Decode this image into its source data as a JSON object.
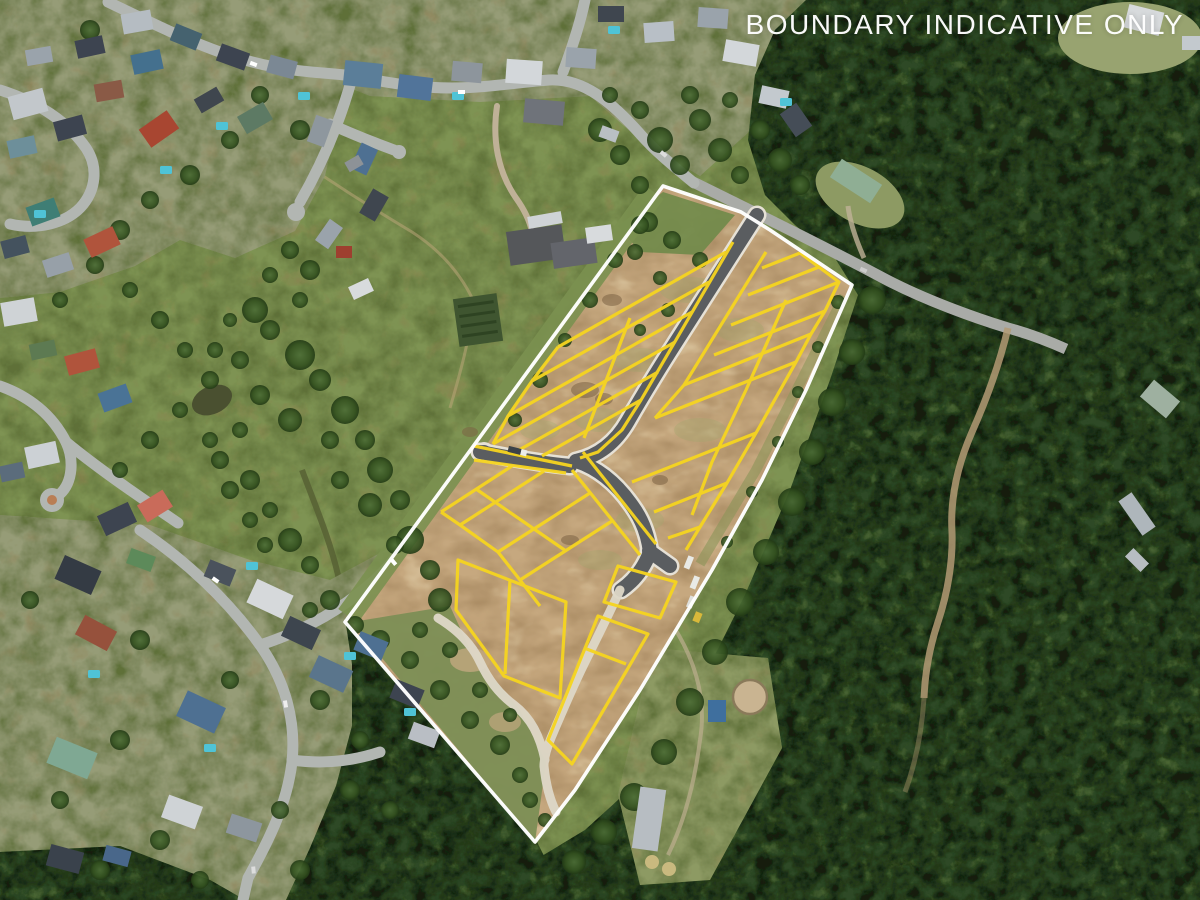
{
  "overlay": {
    "disclaimer": "BOUNDARY INDICATIVE ONLY",
    "text_color": "#ffffff"
  },
  "map": {
    "site_boundary": {
      "label": "estate site boundary",
      "color": "#ffffff"
    },
    "lot_lines": {
      "label": "subdivision lot boundaries",
      "color": "#f6d51f"
    },
    "regions": {
      "west": "suburban streets and houses",
      "center": "grass paddocks and creek",
      "site": "cleared residential lots with new roads",
      "east": "native bushland"
    }
  }
}
